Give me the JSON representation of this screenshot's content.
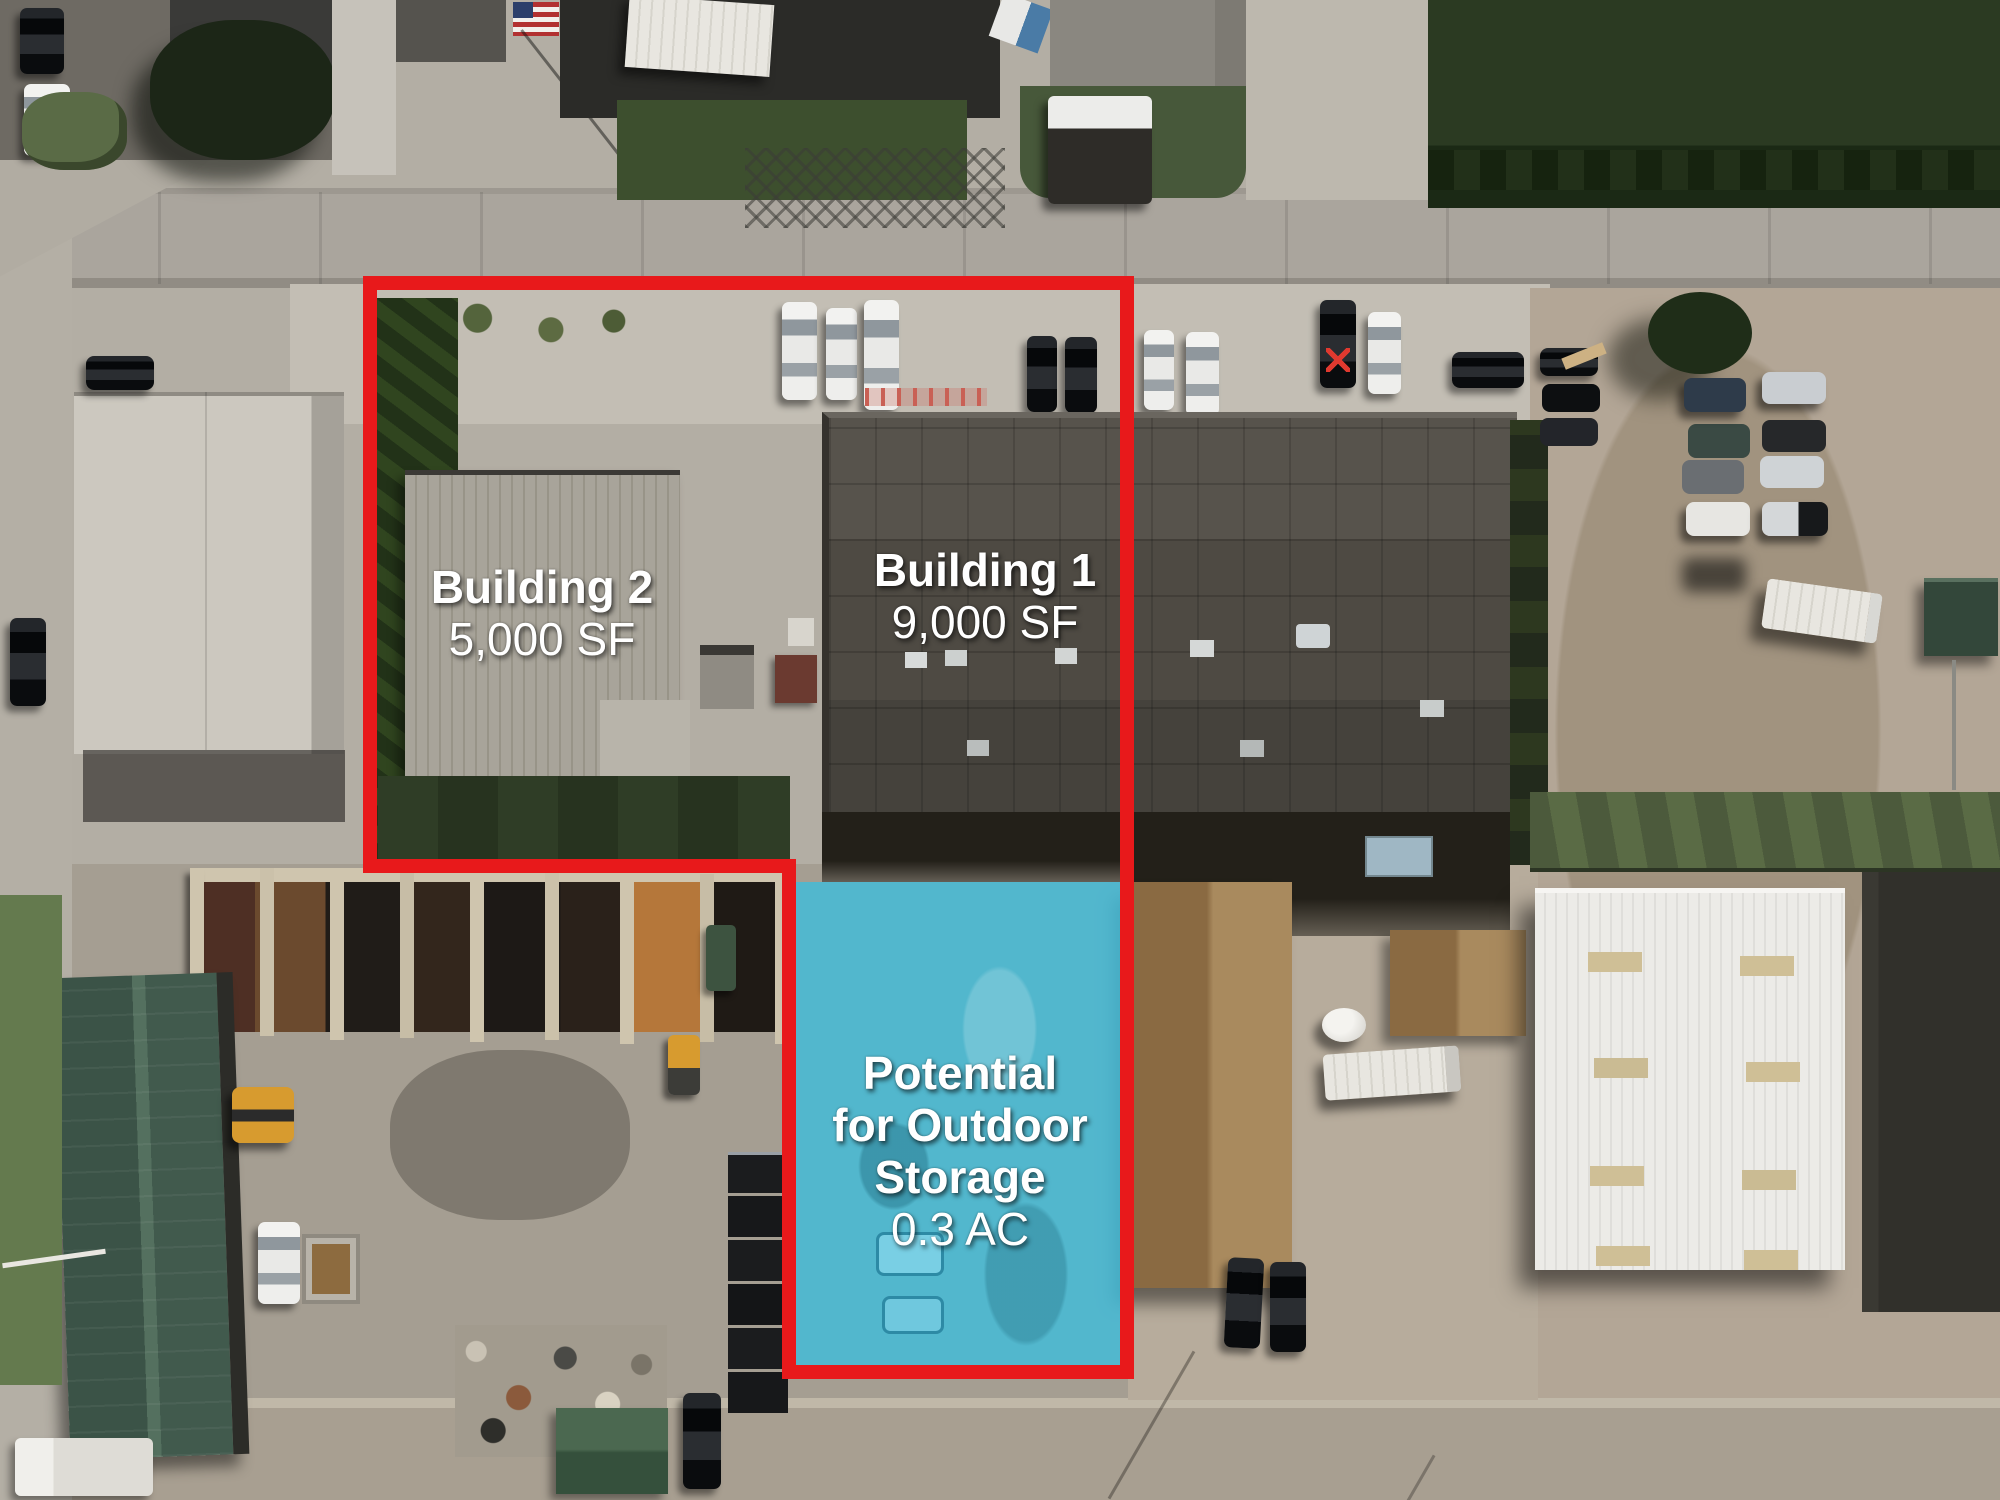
{
  "page": {
    "description": "Aerial drone photo of industrial property with marketing annotations"
  },
  "annotations": {
    "building1": {
      "name": "Building 1",
      "size": "9,000 SF"
    },
    "building2": {
      "name": "Building 2",
      "size": "5,000 SF"
    },
    "storage": {
      "line1": "Potential",
      "line2": "for Outdoor",
      "line3": "Storage",
      "size": "0.3 AC"
    }
  },
  "colors": {
    "boundary": "#e8191b",
    "storage_fill": "#3fbcda",
    "label": "#ffffff"
  }
}
